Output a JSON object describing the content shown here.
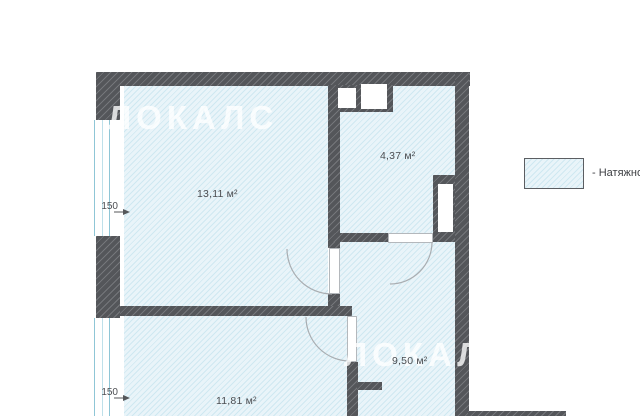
{
  "plan": {
    "watermark_top": "ЛОКАЛС",
    "watermark_bottom": "ЛОКАЛС",
    "rooms": [
      {
        "area": "13,11 м²"
      },
      {
        "area": "4,37 м²"
      },
      {
        "area": "9,50 м²"
      },
      {
        "area": "11,81 м²"
      }
    ],
    "dimensions": [
      {
        "label": "150"
      },
      {
        "label": "150"
      }
    ]
  },
  "legend": {
    "label": "- Натяжно"
  },
  "colors": {
    "floor_base": "#e9f4f9",
    "floor_hatch": "#cfe8f1",
    "wall_dark": "#54565a",
    "wall_hatch": "#75777b",
    "window_frame": "#8fc6d6",
    "door_arc": "#a9adb1",
    "text": "#4b4d51",
    "watermark": "#ffffff"
  }
}
